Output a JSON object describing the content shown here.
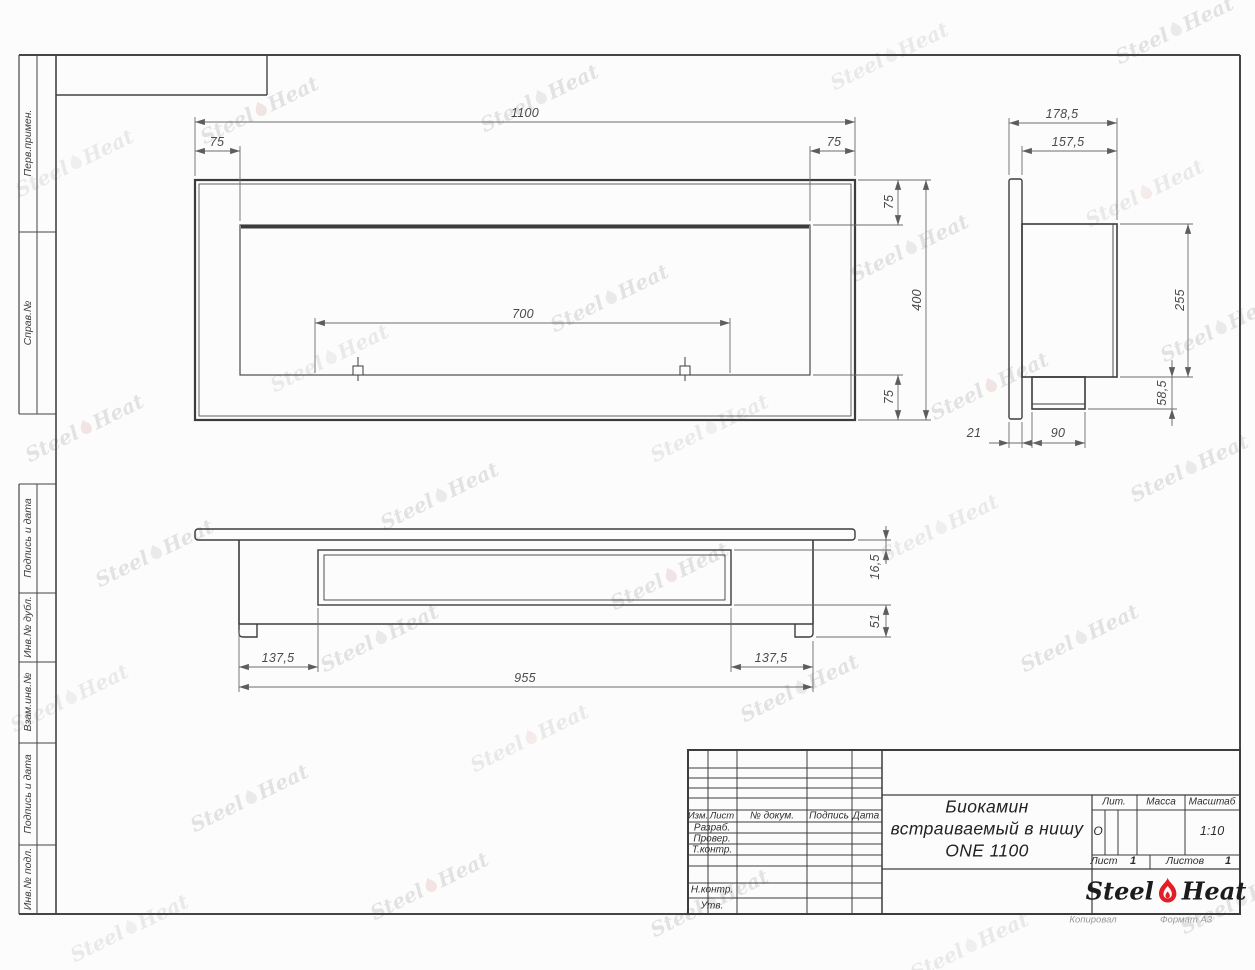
{
  "sidebar": {
    "labels": [
      "Перв.примен.",
      "Справ.№",
      "Подпись и дата",
      "Инв.№ дубл.",
      "Взам.инв.№",
      "Подпись и дата",
      "Инв.№ подл."
    ]
  },
  "views": {
    "front": {
      "total_width": "1100",
      "margin_left": "75",
      "margin_right": "75",
      "opening_width": "700",
      "margin_top": "75",
      "total_height": "400",
      "margin_bottom": "75"
    },
    "side": {
      "depth_total": "178,5",
      "depth_body": "157,5",
      "body_height": "255",
      "bottom_height": "58,5",
      "flange_thickness": "21",
      "bottom_depth": "90"
    },
    "bottom": {
      "lip": "16,5",
      "foot": "51",
      "inset_left": "137,5",
      "body_width": "955",
      "inset_right": "137,5"
    }
  },
  "title_block": {
    "rev_header": [
      "Изм.",
      "Лист",
      "№ докум.",
      "Подпись",
      "Дата"
    ],
    "row_developed": "Разраб.",
    "row_checked": "Провер.",
    "row_tcontrol": "Т.контр.",
    "row_ncontrol": "Н.контр.",
    "row_approved": "Утв.",
    "name_line1": "Биокамин",
    "name_line2": "встраиваемый в нишу",
    "name_line3": "ONE 1100",
    "lit_label": "Лит.",
    "lit_value": "О",
    "mass_label": "Масса",
    "scale_label": "Масштаб",
    "scale_value": "1:10",
    "sheet_label": "Лист",
    "sheet_value": "1",
    "sheets_label": "Листов",
    "sheets_value": "1"
  },
  "brand": {
    "steel": "Steel",
    "heat": "Heat",
    "flame_color": "#e31e24"
  },
  "footer": {
    "copied": "Копировал",
    "format": "Формат A3"
  }
}
